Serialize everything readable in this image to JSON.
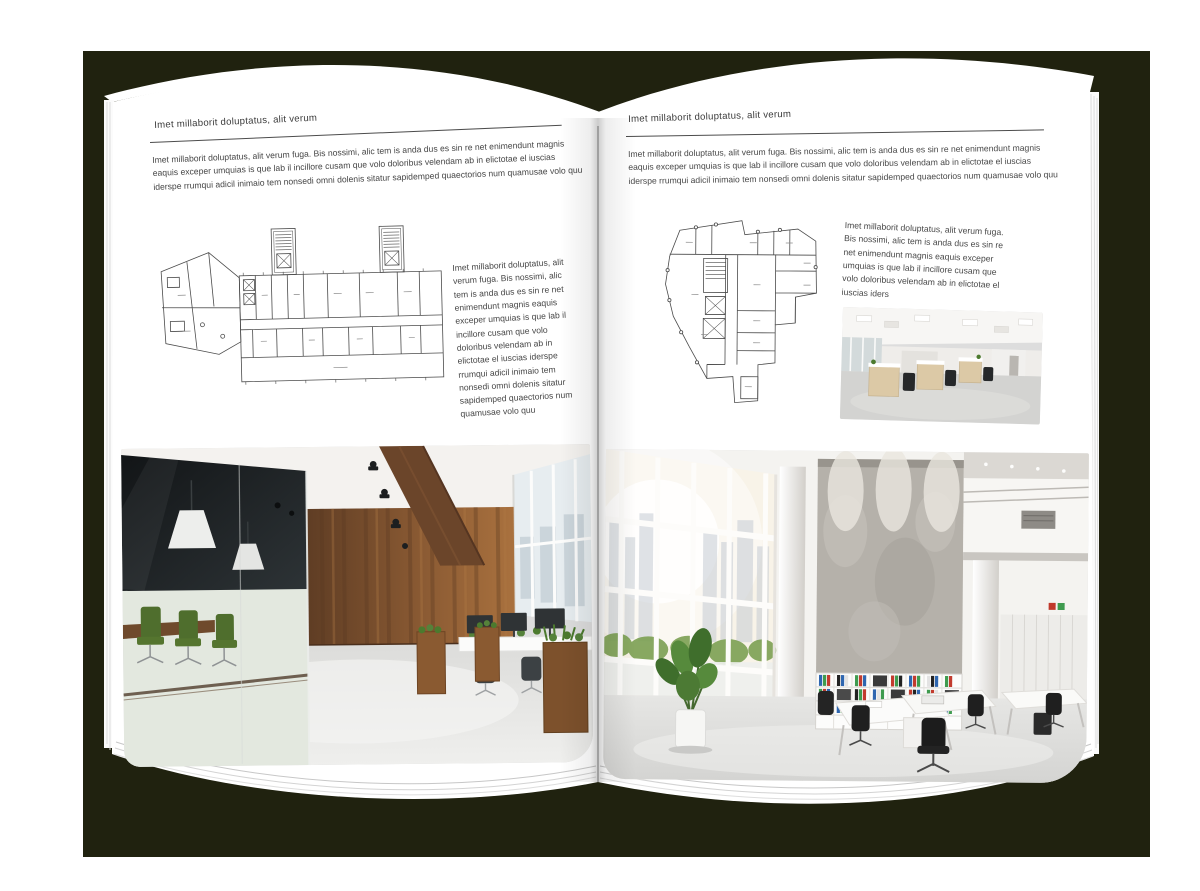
{
  "pages": {
    "left": {
      "header": "Imet millaborit doluptatus, alit verum",
      "intro": "Imet millaborit doluptatus, alit verum fuga. Bis nossimi, alic tem is anda dus es sin re net enimendunt magnis eaquis exceper umquias is que lab il incillore cusam que volo doloribus velendam ab in elictotae el iuscias iderspe rrumqui adicil inimaio tem nonsedi omni dolenis sitatur sapidemped quaectorios num quamusae volo quu",
      "side_text": "Imet millaborit doluptatus, alit verum fuga. Bis nossimi, alic tem is anda dus es sin re net enimendunt magnis eaquis exceper umquias is que lab il incillore cusam que volo doloribus velendam ab in elictotae el iuscias iderspe rrumqui adicil inimaio tem nonsedi omni dolenis sitatur sapidemped quaectorios num quamusae volo quu"
    },
    "right": {
      "header": "Imet millaborit doluptatus, alit verum",
      "intro": "Imet millaborit doluptatus, alit verum fuga. Bis nossimi, alic tem is anda dus es sin re net enimendunt magnis eaquis exceper umquias is que lab il incillore cusam que volo doloribus velendam ab in elictotae el iuscias iderspe rrumqui adicil inimaio tem nonsedi omni dolenis sitatur sapidemped quaectorios num quamusae volo quu",
      "side_text": "Imet millaborit doluptatus, alit verum fuga. Bis nossimi, alic tem is anda dus es sin re net enimendunt magnis eaquis exceper umquias is que lab il incillore cusam que volo doloribus velendam ab in elictotae el iuscias iders"
    }
  },
  "colors": {
    "backdrop": "#20220f",
    "page": "#ffffff",
    "text": "#474747",
    "rule": "#4c4c4c",
    "wood": "#8a5a33",
    "plant_green": "#4c7a2e",
    "binder_blue": "#2e66b0",
    "binder_green": "#3f9b4f",
    "binder_red": "#c23b2e"
  }
}
